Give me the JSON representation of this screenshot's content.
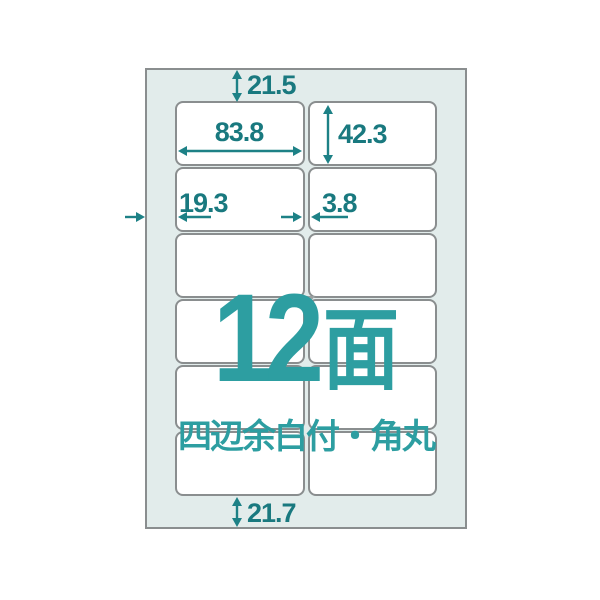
{
  "diagram": {
    "type": "label-sheet-layout",
    "face_count": "12",
    "face_unit": "面",
    "subtitle": "四辺余白付・角丸",
    "grid": {
      "rows": 6,
      "columns": 2
    },
    "dimensions": {
      "top_margin": "21.5",
      "label_width": "83.8",
      "label_height": "42.3",
      "left_margin": "19.3",
      "column_gap": "3.8",
      "bottom_margin": "21.7"
    },
    "colors": {
      "dimension_teal": "#19797f",
      "arrow_teal": "#1d8186",
      "headline_teal": "#2d9ea1",
      "sheet_background": "#e2eceb",
      "border_gray": "#8a8e8f",
      "label_fill": "#ffffff",
      "page_background": "#ffffff"
    }
  }
}
